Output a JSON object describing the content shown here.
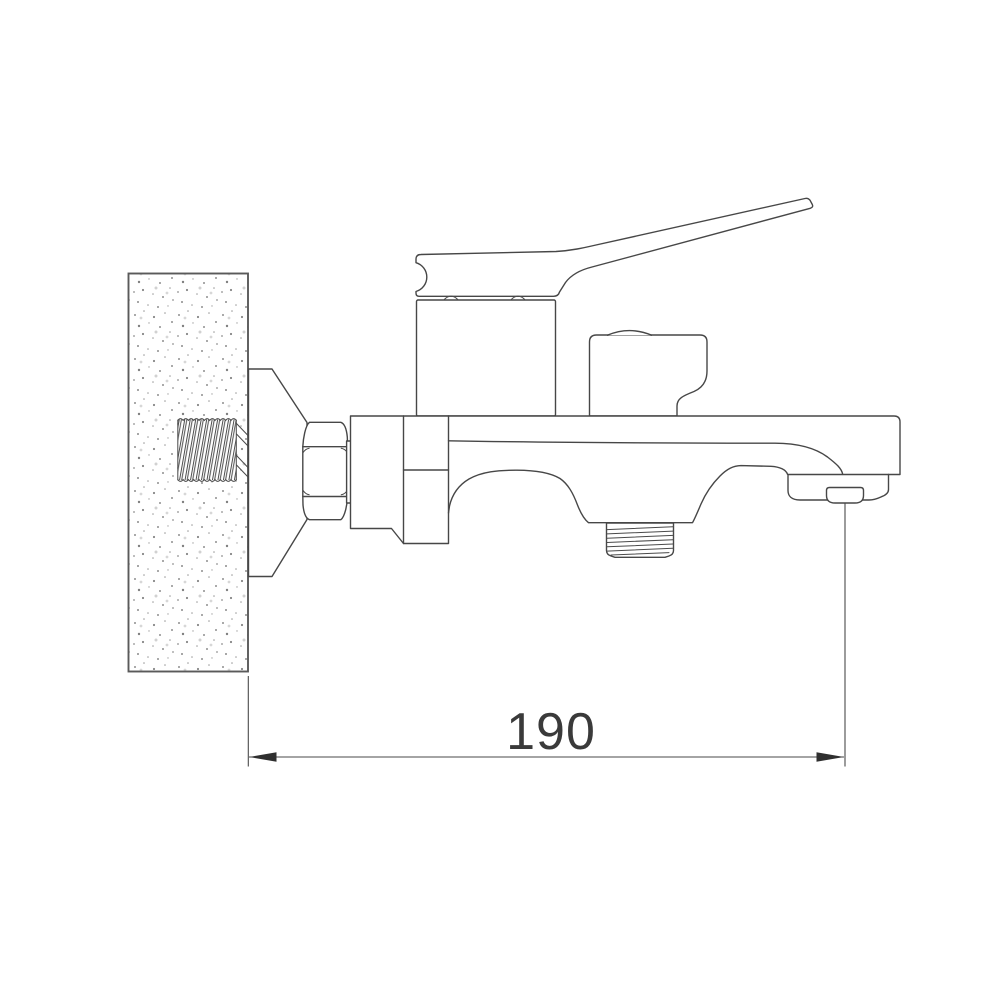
{
  "drawing": {
    "kind": "technical-line-drawing",
    "subject": "wall-mounted single-lever bath mixer faucet, side view",
    "dimension": {
      "label": "190"
    },
    "colors": {
      "background": "#ffffff",
      "line": "#474747",
      "wall_outline": "#5a5a5a",
      "dimension_text": "#3a3a3a",
      "arrow": "#2f2f2f",
      "speckle": "#8f8f8f"
    },
    "parts": [
      "wall-section",
      "inlet-thread-tailpiece",
      "escutcheon-cone",
      "hex-nut",
      "connector-collar",
      "cartridge-column",
      "lever-handle",
      "diverter-housing",
      "faucet-body-spout",
      "shower-outlet-thread",
      "aerator",
      "dimension-annotation"
    ]
  }
}
